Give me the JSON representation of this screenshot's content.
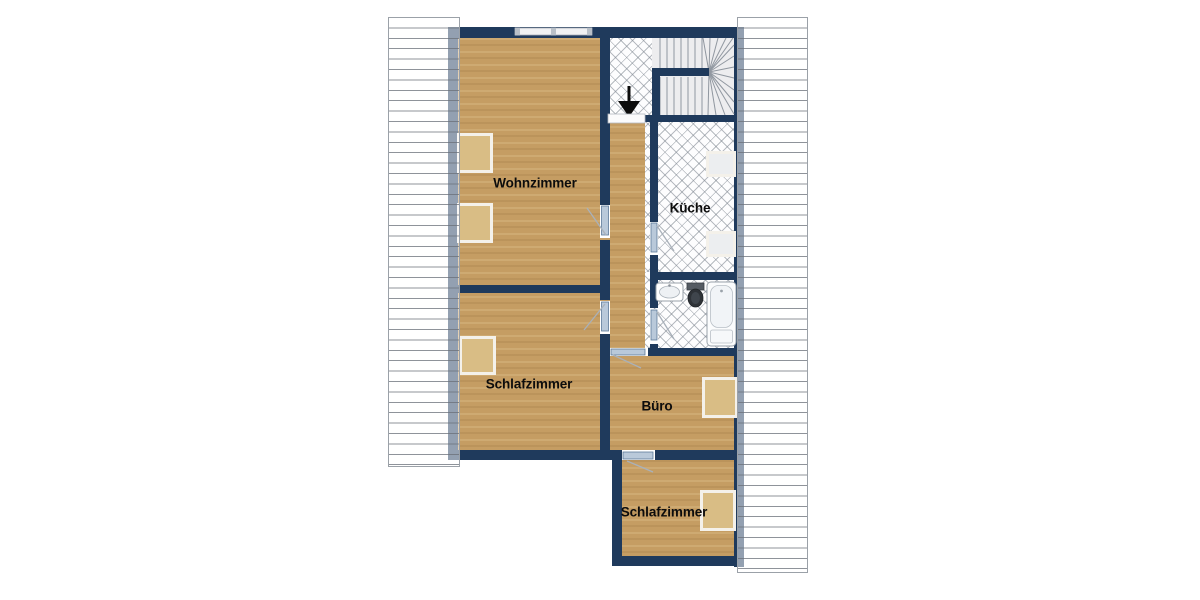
{
  "plan": {
    "rooms": [
      {
        "id": "wohnzimmer",
        "label": "Wohnzimmer"
      },
      {
        "id": "kueche",
        "label": "Küche"
      },
      {
        "id": "schlafzimmer-mitte",
        "label": "Schlafzimmer"
      },
      {
        "id": "buero",
        "label": "Büro"
      },
      {
        "id": "schlafzimmer-unten",
        "label": "Schlafzimmer"
      }
    ],
    "fixtures": [
      {
        "name": "staircase"
      },
      {
        "name": "stair-direction-arrow"
      },
      {
        "name": "washbasin"
      },
      {
        "name": "toilet"
      },
      {
        "name": "bathtub"
      }
    ],
    "roof_areas": [
      "left",
      "right"
    ]
  },
  "colors": {
    "wall": "#1f3a5c",
    "wood": "#c59d63",
    "windowWood": "#d9bd85",
    "windowLight": "#eceef0",
    "windowBorder": "#f4f1ea",
    "tile_line": "#7d858f",
    "roof_line": "#696f78",
    "stair_line": "#9097a0",
    "door_leaf": "#b9c9da",
    "door_swing": "#a9b1ba",
    "label": "#0c0c0c"
  }
}
